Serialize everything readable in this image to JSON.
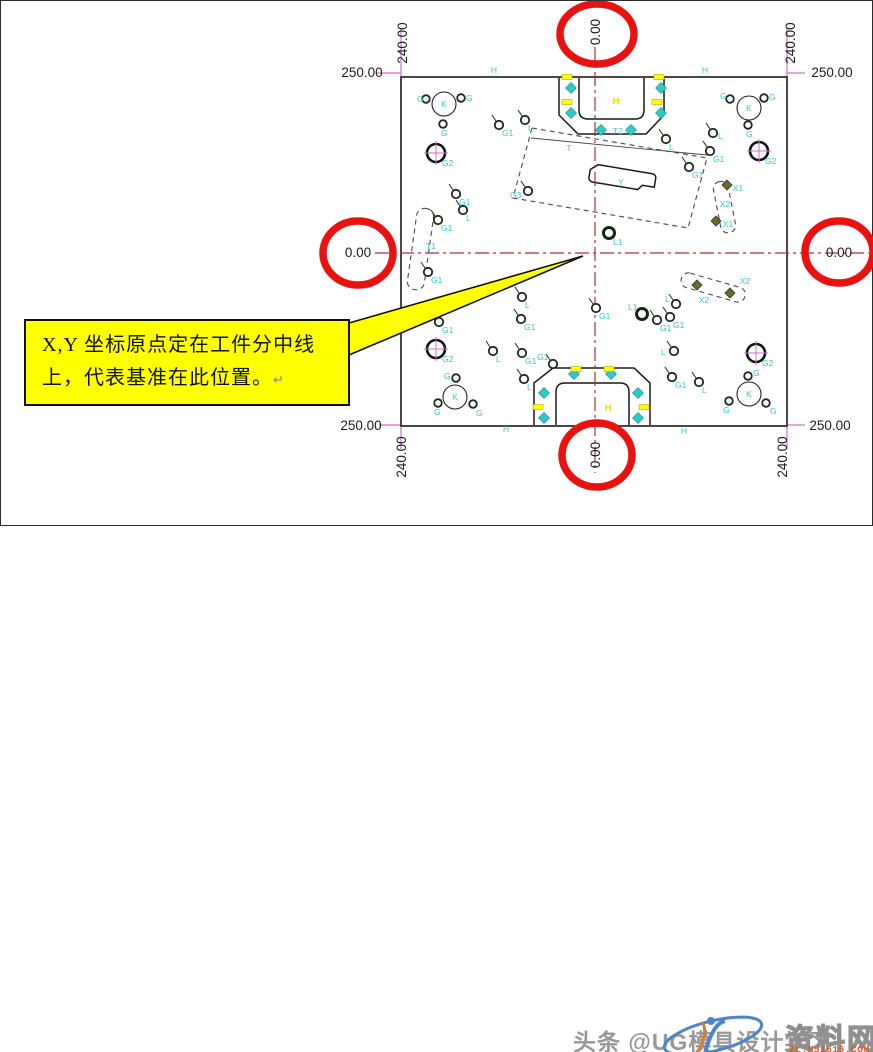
{
  "colors": {
    "cyan": "#2fc9c9",
    "yellow": "#ffff00",
    "yellowtext": "#e8e000",
    "magenta": "#cf6fcf",
    "centerred": "#a83232",
    "circlered": "#e81210"
  },
  "callout": {
    "line1": "X,Y 坐标原点定在工件分中线",
    "line2": "上，代表基准在此位置。",
    "return_mark": "↵"
  },
  "watermark": {
    "headline": "头条 @UG模具设计学习",
    "brand": "资料网",
    "url": "ZL.XS1616.COM"
  },
  "drawing": {
    "plate": {
      "x": 400,
      "y": 76,
      "w": 386,
      "h": 349
    },
    "center_lines": [
      {
        "x1": 594,
        "y1": 46,
        "x2": 594,
        "y2": 472
      },
      {
        "x1": 374,
        "y1": 252,
        "x2": 868,
        "y2": 252
      }
    ],
    "ext_lines": [
      {
        "x1": 400,
        "y1": 28,
        "x2": 400,
        "y2": 76
      },
      {
        "x1": 786,
        "y1": 28,
        "x2": 786,
        "y2": 76
      },
      {
        "x1": 400,
        "y1": 425,
        "x2": 400,
        "y2": 448
      },
      {
        "x1": 786,
        "y1": 425,
        "x2": 786,
        "y2": 448
      },
      {
        "x1": 376,
        "y1": 72,
        "x2": 400,
        "y2": 72
      },
      {
        "x1": 786,
        "y1": 72,
        "x2": 804,
        "y2": 72
      },
      {
        "x1": 378,
        "y1": 424,
        "x2": 400,
        "y2": 424
      },
      {
        "x1": 786,
        "y1": 424,
        "x2": 804,
        "y2": 424
      }
    ],
    "dim_labels": [
      {
        "text": "250.00",
        "x": 361,
        "y": 71,
        "rot": 0
      },
      {
        "text": "240.00",
        "x": 401,
        "y": 42,
        "rot": -90
      },
      {
        "text": "250.00",
        "x": 831,
        "y": 71,
        "rot": 0
      },
      {
        "text": "240.00",
        "x": 789,
        "y": 42,
        "rot": -90
      },
      {
        "text": "0.00",
        "x": 594,
        "y": 31,
        "rot": -90
      },
      {
        "text": "0.00",
        "x": 357,
        "y": 251,
        "rot": 0
      },
      {
        "text": "0.00",
        "x": 838,
        "y": 251,
        "rot": 0
      },
      {
        "text": "0.00",
        "x": 594,
        "y": 454,
        "rot": -90
      },
      {
        "text": "250.00",
        "x": 360,
        "y": 424,
        "rot": 0
      },
      {
        "text": "240.00",
        "x": 400,
        "y": 456,
        "rot": -90
      },
      {
        "text": "250.00",
        "x": 829,
        "y": 424,
        "rot": 0
      },
      {
        "text": "240.00",
        "x": 781,
        "y": 456,
        "rot": -90
      }
    ],
    "red_circles": [
      {
        "cx": 596,
        "cy": 33,
        "rx": 37,
        "ry": 30
      },
      {
        "cx": 357,
        "cy": 252,
        "rx": 35,
        "ry": 32
      },
      {
        "cx": 838,
        "cy": 251,
        "rx": 34,
        "ry": 31
      },
      {
        "cx": 596,
        "cy": 454,
        "rx": 35,
        "ry": 32
      }
    ],
    "markers": [
      {
        "type": "k",
        "x": 443,
        "y": 103,
        "label": "K"
      },
      {
        "type": "sat",
        "x": 425,
        "y": 98,
        "label": "G",
        "dx": -9,
        "dy": 3
      },
      {
        "type": "sat",
        "x": 460,
        "y": 97,
        "label": "G",
        "dx": 5,
        "dy": 3
      },
      {
        "type": "sat",
        "x": 442,
        "y": 123,
        "label": "G",
        "dx": -2,
        "dy": 12
      },
      {
        "type": "k",
        "x": 748,
        "y": 107,
        "label": "K"
      },
      {
        "type": "sat",
        "x": 729,
        "y": 98,
        "label": "G",
        "dx": -10,
        "dy": 0
      },
      {
        "type": "sat",
        "x": 763,
        "y": 97,
        "label": "G",
        "dx": 5,
        "dy": 2
      },
      {
        "type": "sat",
        "x": 747,
        "y": 124,
        "label": "G",
        "dx": -2,
        "dy": 12
      },
      {
        "type": "k",
        "x": 454,
        "y": 396,
        "label": "K"
      },
      {
        "type": "sat",
        "x": 455,
        "y": 377,
        "label": "G",
        "dx": -12,
        "dy": 1
      },
      {
        "type": "sat",
        "x": 437,
        "y": 402,
        "label": "G",
        "dx": -4,
        "dy": 12
      },
      {
        "type": "sat",
        "x": 472,
        "y": 403,
        "label": "G",
        "dx": 3,
        "dy": 12
      },
      {
        "type": "k",
        "x": 748,
        "y": 393,
        "label": "K"
      },
      {
        "type": "sat",
        "x": 747,
        "y": 375,
        "label": "G",
        "dx": 5,
        "dy": 0
      },
      {
        "type": "sat",
        "x": 728,
        "y": 400,
        "label": "G",
        "dx": -6,
        "dy": 12
      },
      {
        "type": "sat",
        "x": 765,
        "y": 402,
        "label": "G",
        "dx": 4,
        "dy": 11
      },
      {
        "type": "g2",
        "x": 435,
        "y": 152,
        "label": "G2"
      },
      {
        "type": "g2",
        "x": 758,
        "y": 150,
        "label": "G2"
      },
      {
        "type": "g2",
        "x": 435,
        "y": 348,
        "label": "G2"
      },
      {
        "type": "g2",
        "x": 755,
        "y": 352,
        "label": "G2"
      },
      {
        "type": "dot",
        "x": 455,
        "y": 193,
        "label": "G1"
      },
      {
        "type": "dot",
        "x": 462,
        "y": 209,
        "label": "L"
      },
      {
        "type": "dot",
        "x": 437,
        "y": 219,
        "label": "G1"
      },
      {
        "type": "dot",
        "x": 427,
        "y": 271,
        "label": "G1"
      },
      {
        "type": "dot",
        "x": 438,
        "y": 321,
        "label": "G1"
      },
      {
        "type": "dot",
        "x": 498,
        "y": 124,
        "label": "G1"
      },
      {
        "type": "dot",
        "x": 524,
        "y": 119,
        "label": "L"
      },
      {
        "type": "dot",
        "x": 527,
        "y": 190,
        "label": "G3",
        "dx": -18,
        "dy": 7
      },
      {
        "type": "dot",
        "x": 595,
        "y": 307,
        "label": "G1"
      },
      {
        "type": "dot",
        "x": 656,
        "y": 319,
        "label": "G1"
      },
      {
        "type": "dot",
        "x": 669,
        "y": 316,
        "label": "G1",
        "dx": 3,
        "dy": 11
      },
      {
        "type": "dot",
        "x": 675,
        "y": 303,
        "label": "L",
        "dx": -11,
        "dy": -2
      },
      {
        "type": "dot",
        "x": 521,
        "y": 296,
        "label": "L"
      },
      {
        "type": "dot",
        "x": 520,
        "y": 318,
        "label": "G1"
      },
      {
        "type": "dot",
        "x": 492,
        "y": 350,
        "label": "L"
      },
      {
        "type": "dot",
        "x": 521,
        "y": 352,
        "label": "G1"
      },
      {
        "type": "dot",
        "x": 523,
        "y": 378,
        "label": "L"
      },
      {
        "type": "dot",
        "x": 673,
        "y": 350,
        "label": "L",
        "dx": -13,
        "dy": 4
      },
      {
        "type": "dot",
        "x": 671,
        "y": 376,
        "label": "G1"
      },
      {
        "type": "dot",
        "x": 698,
        "y": 381,
        "label": "L"
      },
      {
        "type": "dot",
        "x": 712,
        "y": 132,
        "label": "L",
        "dx": 5,
        "dy": 6
      },
      {
        "type": "dot",
        "x": 709,
        "y": 150,
        "label": "G1"
      },
      {
        "type": "dot",
        "x": 688,
        "y": 166,
        "label": "G1"
      },
      {
        "type": "dot",
        "x": 665,
        "y": 138,
        "label": "L"
      },
      {
        "type": "dot",
        "x": 552,
        "y": 363,
        "label": "G1",
        "dx": -16,
        "dy": -4
      },
      {
        "type": "bold",
        "x": 608,
        "y": 232,
        "label": "L1"
      },
      {
        "type": "bold",
        "x": 641,
        "y": 313,
        "label": "L1",
        "dx": -14,
        "dy": -4
      },
      {
        "type": "dia",
        "x": 570,
        "y": 87
      },
      {
        "type": "dia",
        "x": 570,
        "y": 112
      },
      {
        "type": "dia",
        "x": 660,
        "y": 87
      },
      {
        "type": "dia",
        "x": 660,
        "y": 112
      },
      {
        "type": "dia",
        "x": 600,
        "y": 129
      },
      {
        "type": "dia",
        "x": 630,
        "y": 129
      },
      {
        "type": "dia",
        "x": 543,
        "y": 392
      },
      {
        "type": "dia",
        "x": 543,
        "y": 417
      },
      {
        "type": "dia",
        "x": 637,
        "y": 392
      },
      {
        "type": "dia",
        "x": 637,
        "y": 417
      },
      {
        "type": "dia",
        "x": 573,
        "y": 373
      },
      {
        "type": "dia",
        "x": 610,
        "y": 373
      },
      {
        "type": "ddia",
        "x": 726,
        "y": 184
      },
      {
        "type": "ddia",
        "x": 715,
        "y": 220
      },
      {
        "type": "ddia",
        "x": 696,
        "y": 284
      },
      {
        "type": "ddia",
        "x": 729,
        "y": 292
      },
      {
        "type": "ymark",
        "x": 566,
        "y": 76
      },
      {
        "type": "ymark",
        "x": 658,
        "y": 76
      },
      {
        "type": "ymark",
        "x": 566,
        "y": 101
      },
      {
        "type": "ymark",
        "x": 656,
        "y": 101
      },
      {
        "type": "ymark",
        "x": 537,
        "y": 406
      },
      {
        "type": "ymark",
        "x": 643,
        "y": 406
      },
      {
        "type": "ymark",
        "x": 575,
        "y": 368
      },
      {
        "type": "ymark",
        "x": 608,
        "y": 368
      },
      {
        "type": "lbl",
        "x": 568,
        "y": 150,
        "label": "T"
      },
      {
        "type": "lbl",
        "x": 430,
        "y": 248,
        "label": "T1"
      },
      {
        "type": "lbl",
        "x": 620,
        "y": 184,
        "label": "Y"
      },
      {
        "type": "lbl",
        "x": 724,
        "y": 206,
        "label": "X2"
      },
      {
        "type": "lbl",
        "x": 703,
        "y": 302,
        "label": "X2"
      },
      {
        "type": "lbl",
        "x": 744,
        "y": 283,
        "label": "X2"
      },
      {
        "type": "lbl",
        "x": 737,
        "y": 190,
        "label": "X1"
      },
      {
        "type": "lbl",
        "x": 727,
        "y": 226,
        "label": "X1"
      },
      {
        "type": "lbl",
        "x": 617,
        "y": 133,
        "label": "T2"
      },
      {
        "type": "lbl",
        "x": 493,
        "y": 72,
        "label": "H"
      },
      {
        "type": "lbl",
        "x": 704,
        "y": 72,
        "label": "H"
      },
      {
        "type": "lbl",
        "x": 505,
        "y": 431,
        "label": "H"
      },
      {
        "type": "lbl",
        "x": 683,
        "y": 433,
        "label": "H"
      },
      {
        "type": "ylbl",
        "x": 615,
        "y": 103,
        "label": "H"
      },
      {
        "type": "ylbl",
        "x": 607,
        "y": 410,
        "label": "H"
      }
    ]
  }
}
